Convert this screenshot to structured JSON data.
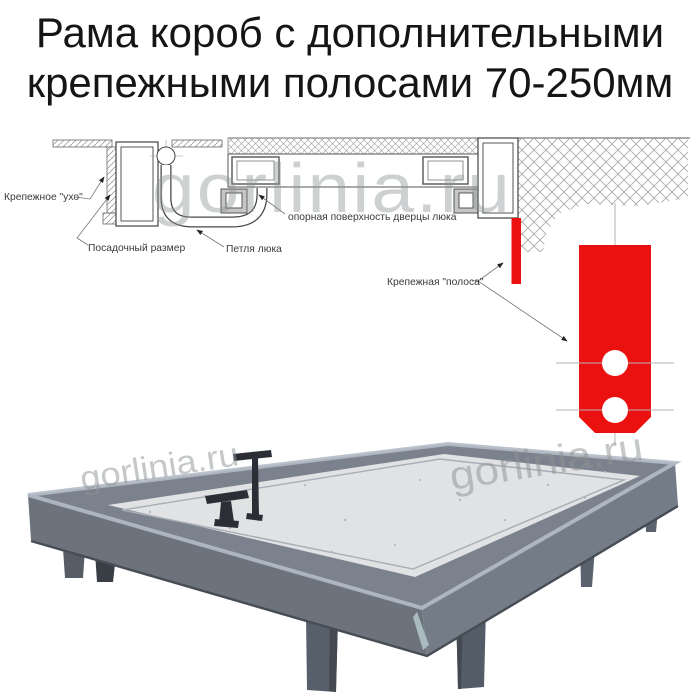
{
  "title": {
    "line1": "Рама короб с дополнительными",
    "line2": "крепежными полосами 70-250мм"
  },
  "diagram": {
    "labels": {
      "ear": "Крепежное \"ухо\"",
      "seat_size": "Посадочный размер",
      "hinge": "Петля люка",
      "support_surface": "опорная поверхность дверцы люка",
      "strip": "Крепежная \"полоса\""
    }
  },
  "watermark": {
    "text": "gorlinia.ru"
  },
  "colors": {
    "strip_red": "#ec1111",
    "metal_gray": "#7b828d",
    "panel_gray": "#e0e2e3"
  }
}
